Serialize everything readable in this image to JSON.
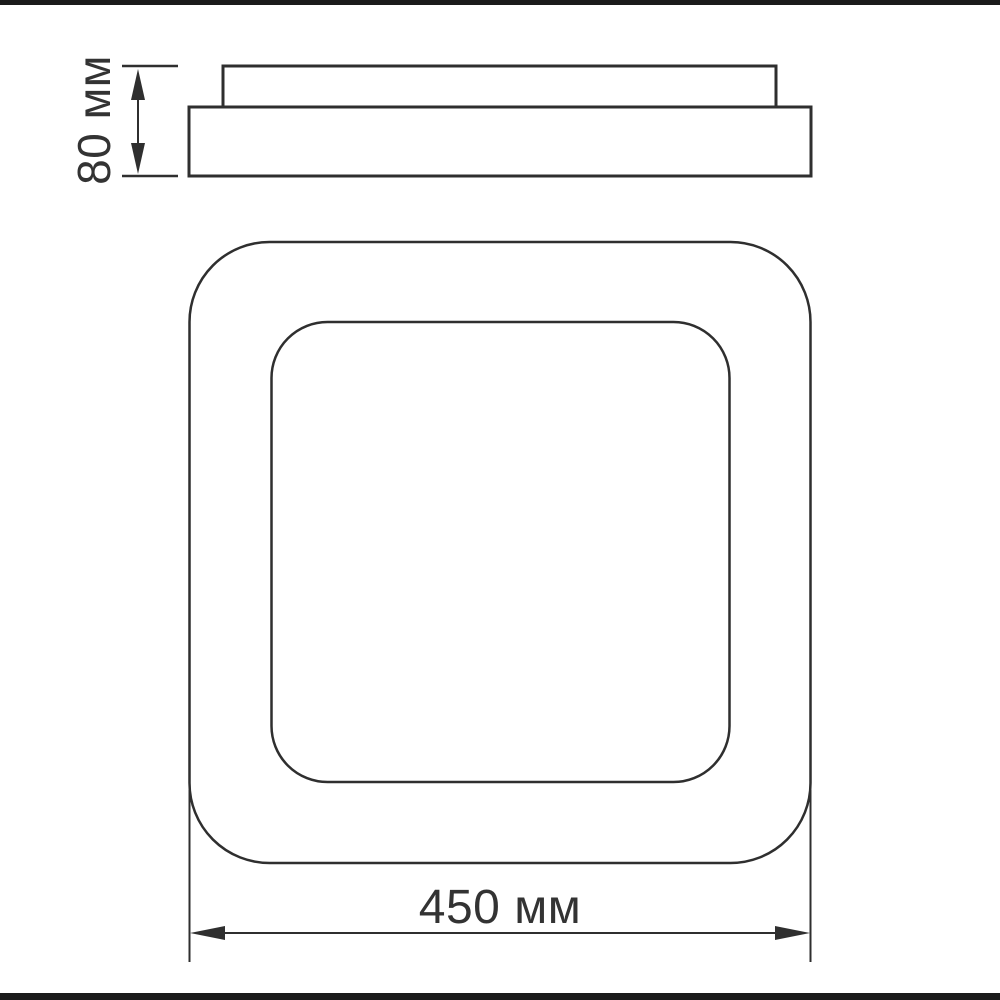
{
  "page": {
    "background": "#ffffff",
    "frame_bar_color": "#1b1b1b"
  },
  "drawing": {
    "description": "technical dimension drawing of a square ceiling LED luminaire: side profile view on top, front view below",
    "line_color": "#2f2f2f",
    "text_color": "#333333",
    "labels": {
      "height": "80 мм",
      "width": "450 мм"
    }
  }
}
